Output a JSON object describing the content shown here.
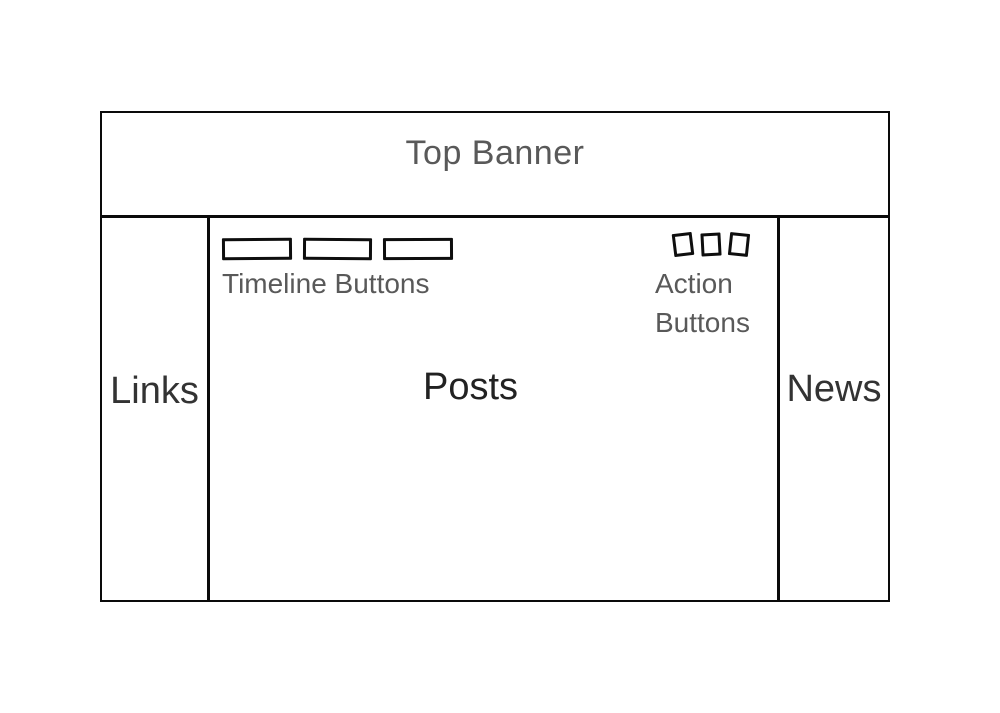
{
  "canvas": {
    "background_color": "#ffffff",
    "line_color": "#0a0a0a"
  },
  "banner": {
    "label": "Top Banner",
    "text_color": "#595959"
  },
  "sidebar_left": {
    "label": "Links",
    "text_color": "#333333"
  },
  "sidebar_right": {
    "label": "News",
    "text_color": "#333333"
  },
  "main": {
    "label": "Posts",
    "text_color": "#222222",
    "timeline_buttons": {
      "label": "Timeline Buttons",
      "count": 3
    },
    "action_buttons": {
      "label_line1": "Action",
      "label_line2": "Buttons",
      "count": 3
    }
  }
}
